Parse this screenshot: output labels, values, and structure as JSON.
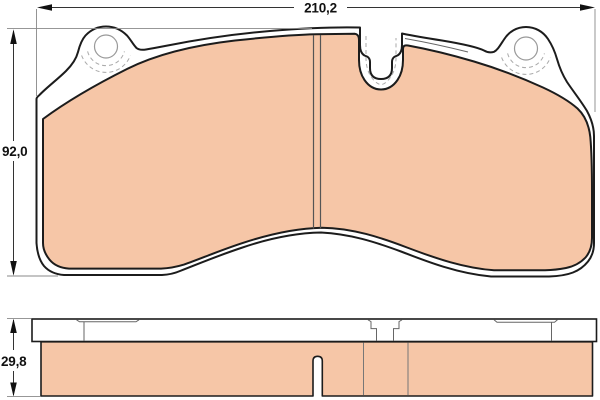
{
  "drawing": {
    "title": "brake-pad-technical-drawing",
    "views": {
      "front": {
        "name": "front-view",
        "features": [
          "backplate",
          "friction-material",
          "left-lug-hole",
          "right-lug-hole",
          "top-center-notch",
          "vertical-wear-groove"
        ]
      },
      "side": {
        "name": "side-view",
        "features": [
          "backplate-strip",
          "friction-block",
          "wear-slot",
          "lug-step-left",
          "lug-step-right",
          "notch-section"
        ]
      }
    },
    "dimensions": {
      "width": {
        "label": "210,2"
      },
      "height": {
        "label": "92,0"
      },
      "thickness": {
        "label": "29,8"
      }
    },
    "colors": {
      "background": "#FFFFFF",
      "friction": "#F6C6A7",
      "backplate": "#FFFFFF",
      "outline": "#1C1C1C",
      "detail_line": "#777777",
      "dashed_line": "#AAAAAA",
      "hole_line": "#999999",
      "dimension_text": "#111111"
    }
  }
}
